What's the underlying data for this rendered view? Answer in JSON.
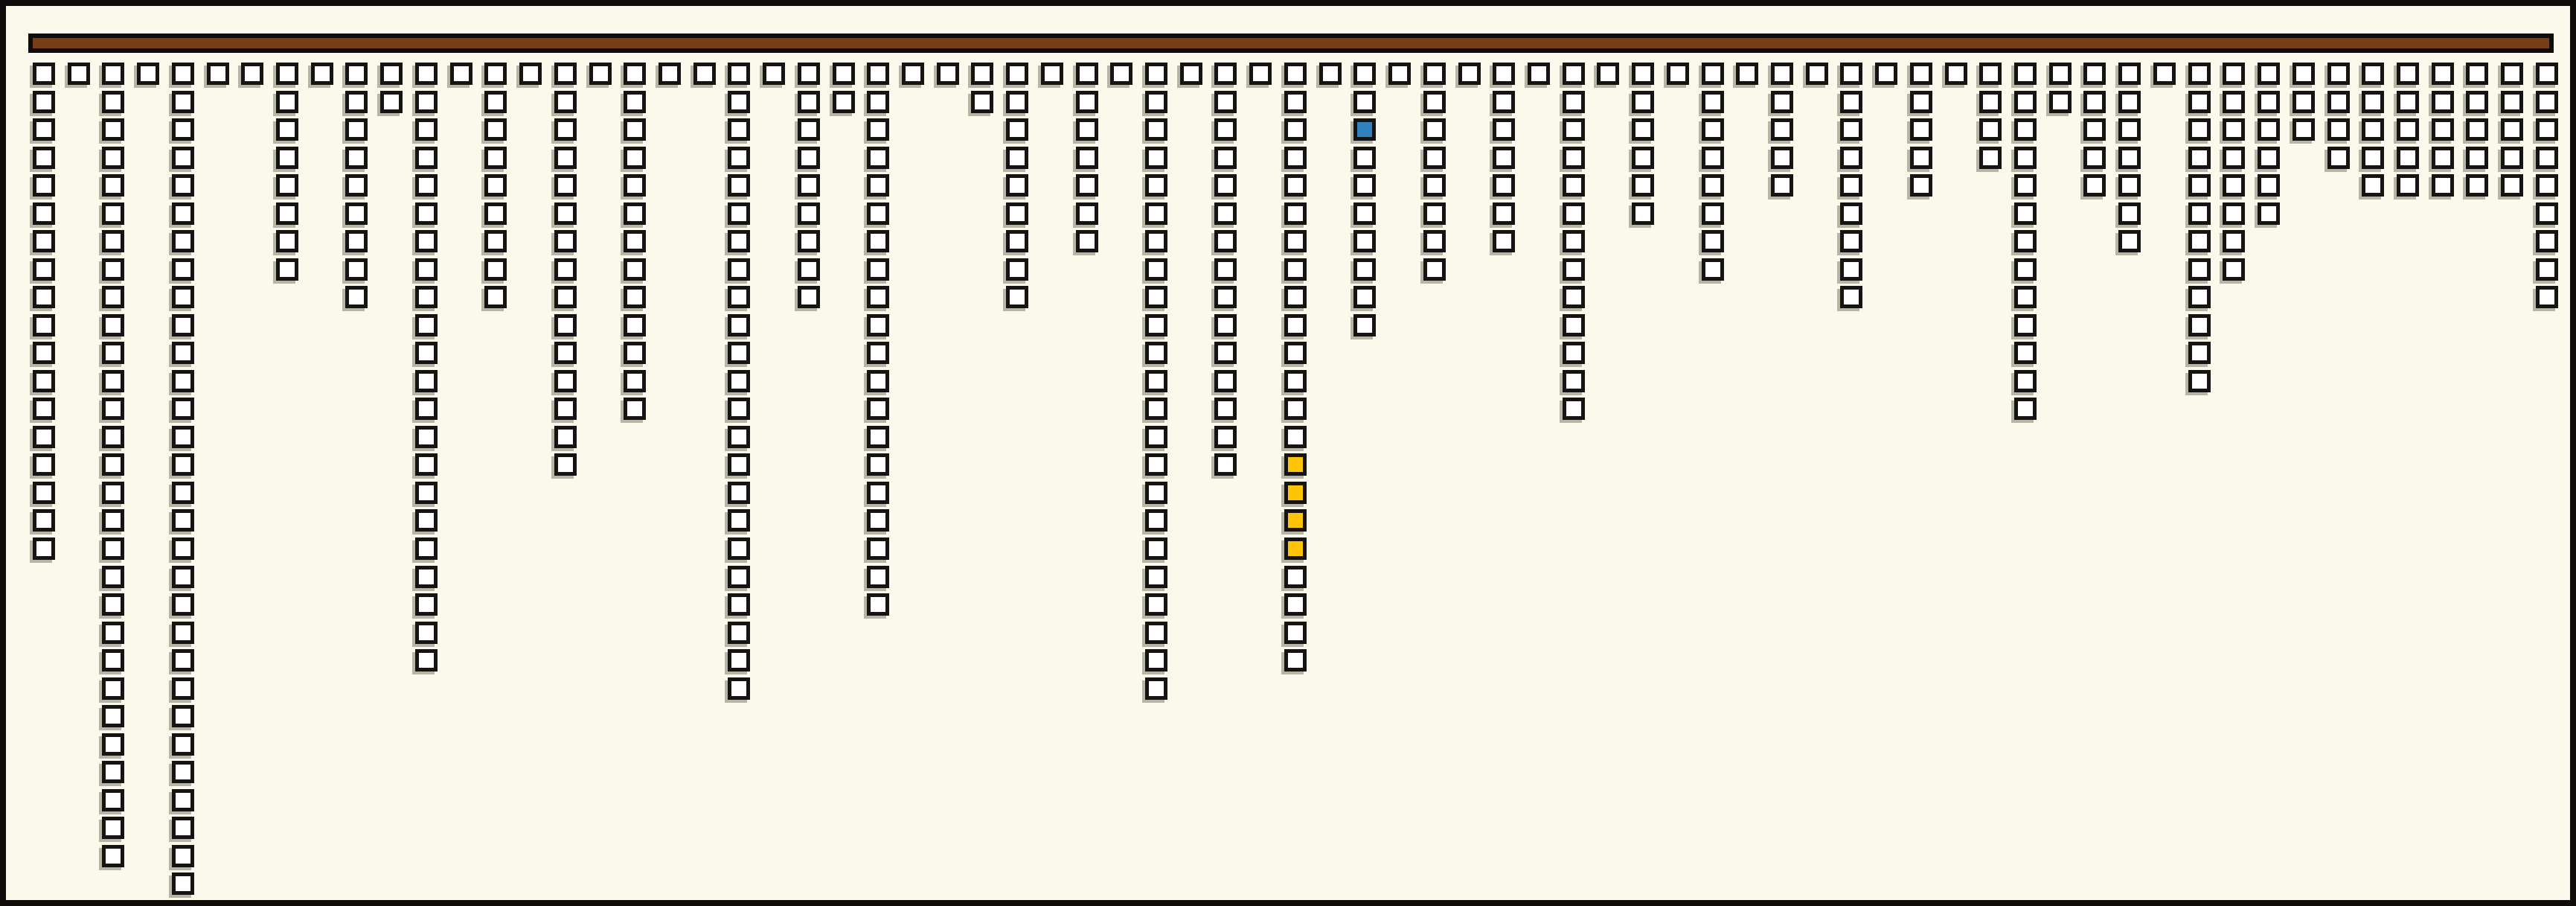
{
  "figure": {
    "kind": "icon-column chart (waffle columns hanging from a top bar)",
    "background_color": "#FBF9EC",
    "frame_color": "#0E0D0B",
    "header_bar_color": "#7A3E16",
    "header_bar_border_color": "#0E0D0B",
    "square_outline_color": "#151412",
    "square_shadow_color": "rgba(100,97,83,0.45)"
  },
  "chart_data": {
    "type": "bar",
    "title": "",
    "xlabel": "",
    "ylabel": "",
    "legend": "none",
    "gridlines": "off",
    "orientation": "columns hang downward from top header bar",
    "n_columns": 73,
    "max_column_length": 30,
    "total_squares": 484,
    "unit": "squares (one icon per unit)",
    "values": [
      18,
      1,
      29,
      1,
      30,
      1,
      1,
      8,
      1,
      9,
      2,
      22,
      1,
      9,
      1,
      15,
      1,
      13,
      1,
      1,
      23,
      1,
      9,
      2,
      20,
      1,
      1,
      2,
      9,
      1,
      7,
      1,
      23,
      1,
      15,
      1,
      22,
      1,
      10,
      1,
      8,
      1,
      7,
      1,
      13,
      1,
      6,
      1,
      8,
      1,
      5,
      1,
      9,
      1,
      5,
      1,
      4,
      13,
      2,
      5,
      7,
      1,
      12,
      8,
      6,
      3,
      4,
      5,
      5,
      5,
      5,
      5,
      9
    ],
    "colors": {
      "default": "#FFFFFF",
      "blue": "#3080BC",
      "gold": "#FDC408"
    },
    "highlighted_squares": [
      {
        "column": 38,
        "row": 2,
        "color": "blue"
      },
      {
        "column": 36,
        "row": 14,
        "color": "gold"
      },
      {
        "column": 36,
        "row": 15,
        "color": "gold"
      },
      {
        "column": 36,
        "row": 16,
        "color": "gold"
      },
      {
        "column": 36,
        "row": 17,
        "color": "gold"
      }
    ]
  }
}
